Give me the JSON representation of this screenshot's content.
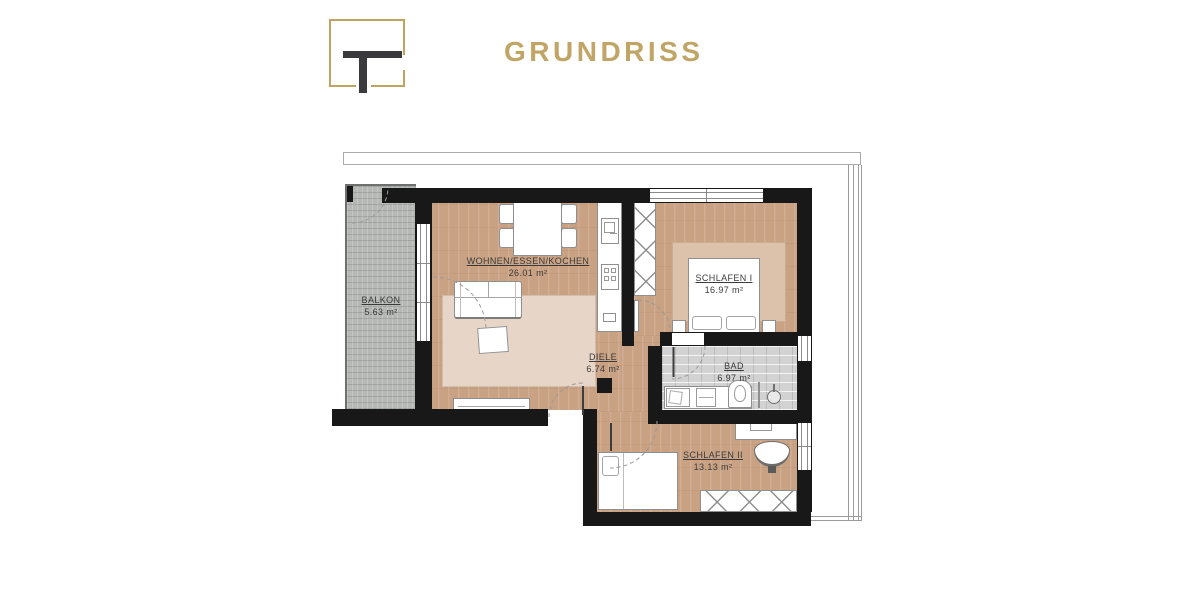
{
  "header": {
    "title": "GRUNDRISS",
    "logo_letter": "T"
  },
  "colors": {
    "gold": "#bfa35e",
    "wall_black": "#181818",
    "wood_floor": "#c9a183",
    "balcony_gray": "#b5b8b4",
    "bath_tile_gray": "#d2d2d2",
    "living_rug": "#e7d6c8",
    "bedroom_rug": "#dcc2ab",
    "label_text": "#3a3a3a"
  },
  "rooms": [
    {
      "name": "BALKON",
      "area": "5.63 m²"
    },
    {
      "name": "WOHNEN/ESSEN/KOCHEN",
      "area": "26.01 m²"
    },
    {
      "name": "SCHLAFEN I",
      "area": "16.97 m²"
    },
    {
      "name": "DIELE",
      "area": "6.74 m²"
    },
    {
      "name": "BAD",
      "area": "6.97 m²"
    },
    {
      "name": "SCHLAFEN II",
      "area": "13.13 m²"
    }
  ]
}
